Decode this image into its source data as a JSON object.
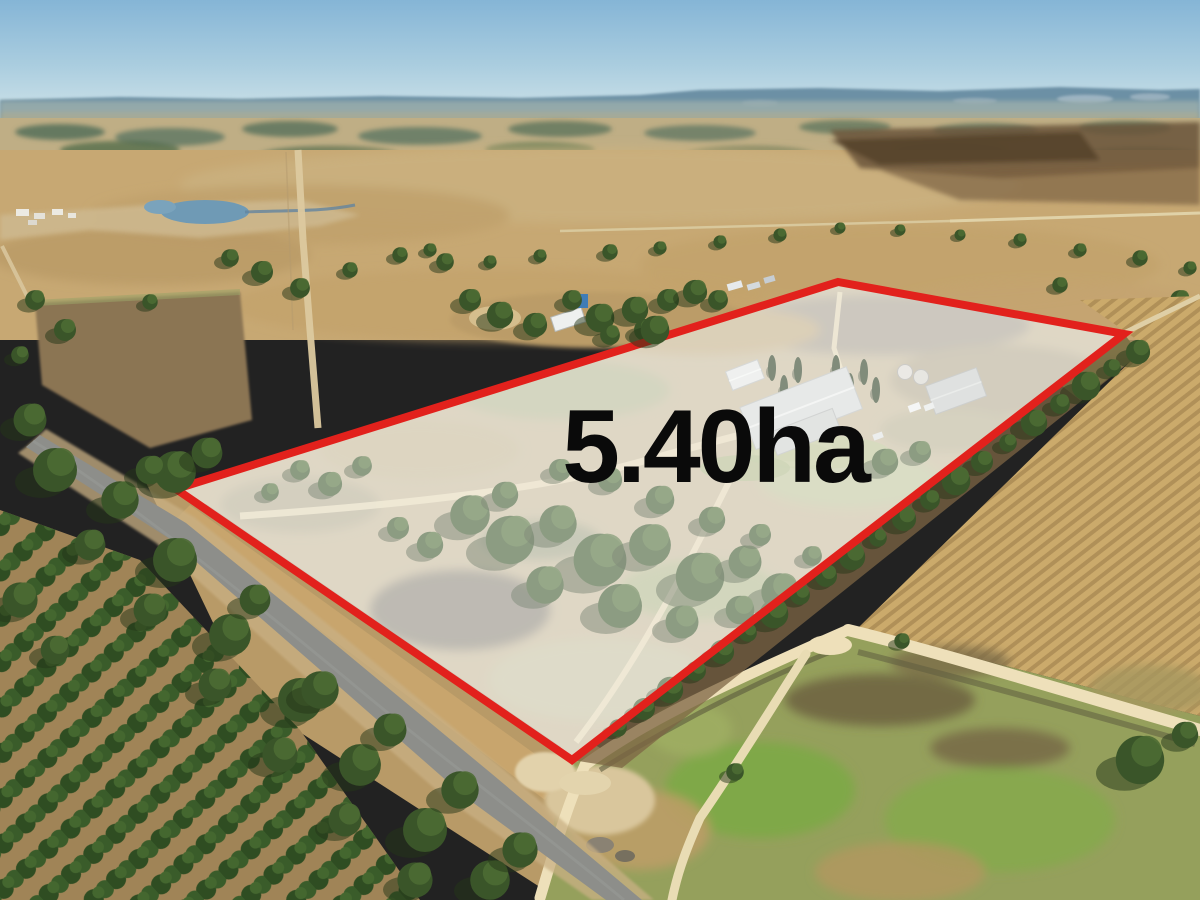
{
  "annotation": {
    "area_label": "5.40ha"
  },
  "colors": {
    "boundary_red": "#e2211c",
    "parcel_overlay_white": "#ffffff",
    "label_black": "#0a0a0a",
    "sky_top": "#85b5d6",
    "sky_mid": "#aacddf",
    "sky_horizon": "#cfe3e9",
    "distant_hills_blue": "#64889f",
    "field_tan": "#c7a873",
    "tree_green": "#3a5529",
    "sealed_road_gray": "#8d8e8a",
    "dirt_track_cream": "#eee0ba",
    "water_blue": "#6f9ab5",
    "orchard_ground": "#a08457",
    "furrow_field": "#cbaa6b",
    "grass_green": "#86a84e"
  },
  "scene": {
    "type": "aerial-photograph",
    "subject": "rural acreage property with red boundary outline"
  }
}
